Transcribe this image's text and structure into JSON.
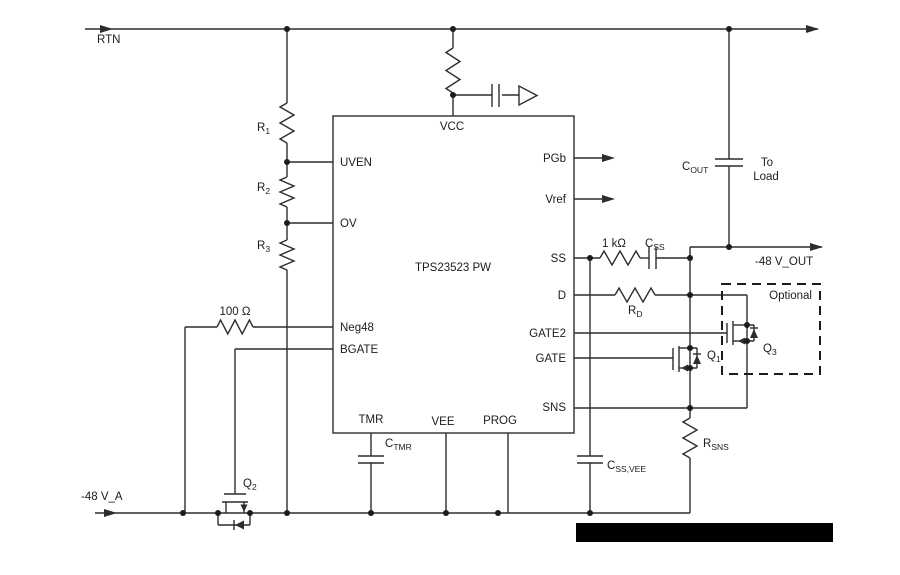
{
  "schematic": {
    "ic": {
      "name": "TPS23523 PW",
      "pins": {
        "vcc": "VCC",
        "uven": "UVEN",
        "ov": "OV",
        "neg48": "Neg48",
        "bgate": "BGATE",
        "tmr": "TMR",
        "vee": "VEE",
        "prog": "PROG",
        "pgb": "PGb",
        "vref": "Vref",
        "ss": "SS",
        "d": "D",
        "gate2": "GATE2",
        "gate": "GATE",
        "sns": "SNS"
      }
    },
    "nets": {
      "rtn": "RTN",
      "input": "-48 V_A",
      "output": "-48 V_OUT",
      "load_line1": "To",
      "load_line2": "Load"
    },
    "components": {
      "r1": {
        "base": "R",
        "sub": "1"
      },
      "r2": {
        "base": "R",
        "sub": "2"
      },
      "r3": {
        "base": "R",
        "sub": "3"
      },
      "r_neg48": "100 Ω",
      "r_ss": "1 kΩ",
      "c_ss": {
        "base": "C",
        "sub": "SS"
      },
      "r_d": {
        "base": "R",
        "sub": "D"
      },
      "c_out": {
        "base": "C",
        "sub": "OUT"
      },
      "c_tmr": {
        "base": "C",
        "sub": "TMR"
      },
      "c_ss_vee": {
        "base": "C",
        "sub": "SS,VEE"
      },
      "r_sns": {
        "base": "R",
        "sub": "SNS"
      },
      "q1": {
        "base": "Q",
        "sub": "1"
      },
      "q2": {
        "base": "Q",
        "sub": "2"
      },
      "q3": {
        "base": "Q",
        "sub": "3"
      }
    },
    "annotations": {
      "optional": "Optional"
    },
    "colors": {
      "wire": "#2d2d2d",
      "text": "#1c1c1c",
      "background": "#ffffff",
      "redaction": "#000000"
    }
  }
}
